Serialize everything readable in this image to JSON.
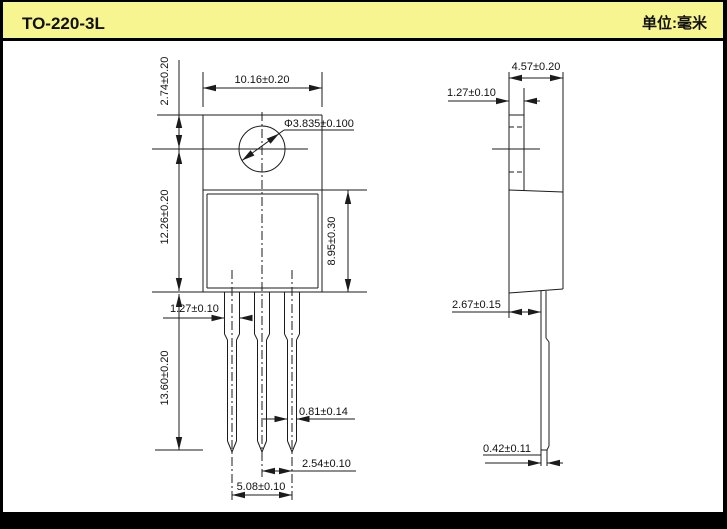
{
  "header": {
    "title": "TO-220-3L",
    "unit_label": "单位:毫米"
  },
  "colors": {
    "header_bg": "#F7F58F",
    "header_text": "#17A26E",
    "frame": "#000000",
    "paper": "#FFFFFF",
    "line": "#1B1B1B"
  },
  "front_view": {
    "dims": {
      "overall_width": "10.16±0.20",
      "hole_diameter": "Φ3.835±0.100",
      "top_to_hole_center": "2.74±0.20",
      "hole_center_to_body_bottom": "12.26±0.20",
      "body_height": "8.95±0.30",
      "lead_upper_width": "1.27±0.10",
      "lead_length": "13.60±0.20",
      "lead_lower_width": "0.81±0.14",
      "lead_pitch": "2.54±0.10",
      "outer_lead_span": "5.08±0.10"
    }
  },
  "side_view": {
    "dims": {
      "overall_depth": "4.57±0.20",
      "tab_thickness": "1.27±0.10",
      "body_depth": "2.67±0.15",
      "lead_thickness": "0.42±0.11"
    }
  }
}
